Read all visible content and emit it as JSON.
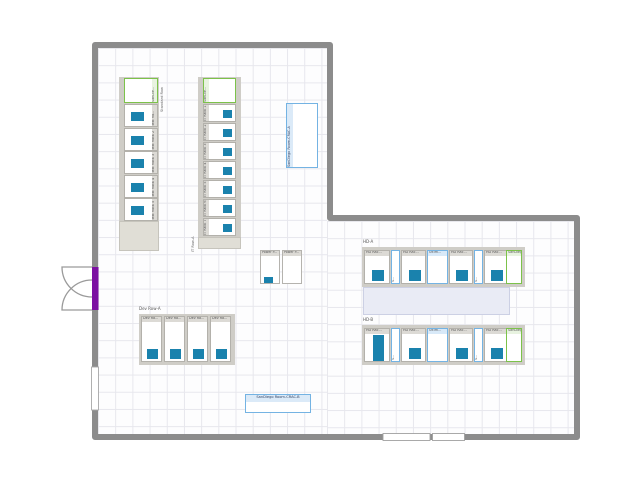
{
  "colors": {
    "wall": "#8c8c8c",
    "chip": "#1a82ad",
    "green_border": "#7cc24a",
    "blue_border": "#74b3e3",
    "purple_door": "#7c10a2",
    "aisle_fill": "#e9ebf5",
    "row_gray": "#cfcdc7",
    "row_beige": "#e0ded6",
    "grid_line": "#e7e7ed"
  },
  "rows": {
    "test": {
      "row_label": "Standard Row",
      "units": [
        {
          "label": "SanDie...",
          "type": "green",
          "chip": false
        },
        {
          "label": "Test Ra...",
          "type": "rack",
          "chip": true
        },
        {
          "label": "Test Rack 2",
          "type": "rack",
          "chip": true
        },
        {
          "label": "Test Rack 3",
          "type": "rack",
          "chip": true
        },
        {
          "label": "Test Rack 4",
          "type": "rack",
          "chip": true
        },
        {
          "label": "Test Rack 5",
          "type": "rack",
          "chip": true
        }
      ]
    },
    "it": {
      "row_label": "IT Row-A",
      "units": [
        {
          "label": "SanDie...",
          "type": "green",
          "chip": false
        },
        {
          "label": "IT Rack 1",
          "type": "rack",
          "chip": true
        },
        {
          "label": "IT Rack 2",
          "type": "rack",
          "chip": true
        },
        {
          "label": "IT Rack 3",
          "type": "rack",
          "chip": true
        },
        {
          "label": "IT Rack 4",
          "type": "rack",
          "chip": true
        },
        {
          "label": "IT Rack 5",
          "type": "rack",
          "chip": true
        },
        {
          "label": "IT Rack 6",
          "type": "rack",
          "chip": true
        },
        {
          "label": "IT Rack 7",
          "type": "rack",
          "chip": true
        }
      ]
    },
    "dev": {
      "row_label": "Dev Row-A",
      "units": [
        {
          "label": "Dev Ra...",
          "type": "rack",
          "chip": true
        },
        {
          "label": "Dev Ra...",
          "type": "rack",
          "chip": true
        },
        {
          "label": "Dev Ra...",
          "type": "rack",
          "chip": true
        },
        {
          "label": "Dev Ra...",
          "type": "rack",
          "chip": true
        }
      ]
    },
    "hda": {
      "row_label": "HD-A",
      "units": [
        {
          "label": "HD Rac...",
          "type": "hd",
          "chip": "small"
        },
        {
          "label": "S...",
          "type": "slim",
          "chip": false
        },
        {
          "label": "HD Rac...",
          "type": "hd",
          "chip": "small"
        },
        {
          "label": "Ultim...",
          "type": "wide",
          "chip": false
        },
        {
          "label": "HD Rac...",
          "type": "hd",
          "chip": "small"
        },
        {
          "label": "S...",
          "type": "slim",
          "chip": false
        },
        {
          "label": "HD Rac...",
          "type": "hd",
          "chip": "small"
        },
        {
          "label": "SanDiego...",
          "type": "green",
          "chip": false
        }
      ]
    },
    "hdb": {
      "row_label": "HD-B",
      "units": [
        {
          "label": "HD Rac...",
          "type": "hd",
          "chip": "tall"
        },
        {
          "label": "S...",
          "type": "slim",
          "chip": false
        },
        {
          "label": "HD Rac...",
          "type": "hd",
          "chip": "small"
        },
        {
          "label": "Ultim...",
          "type": "wide",
          "chip": false
        },
        {
          "label": "HD Rac...",
          "type": "hd",
          "chip": "small"
        },
        {
          "label": "S...",
          "type": "slim",
          "chip": false
        },
        {
          "label": "HD Rac...",
          "type": "hd",
          "chip": "small"
        },
        {
          "label": "SanDiego...",
          "type": "green",
          "chip": false
        }
      ]
    }
  },
  "panels": {
    "power": [
      {
        "label": "Power P...",
        "chip": true
      },
      {
        "label": "Power P...",
        "chip": false
      }
    ],
    "crac_a": {
      "label": "SanDiego Room-CRAC-A"
    },
    "crac_b": {
      "label": "SanDiego Room-CRAC-B"
    }
  }
}
